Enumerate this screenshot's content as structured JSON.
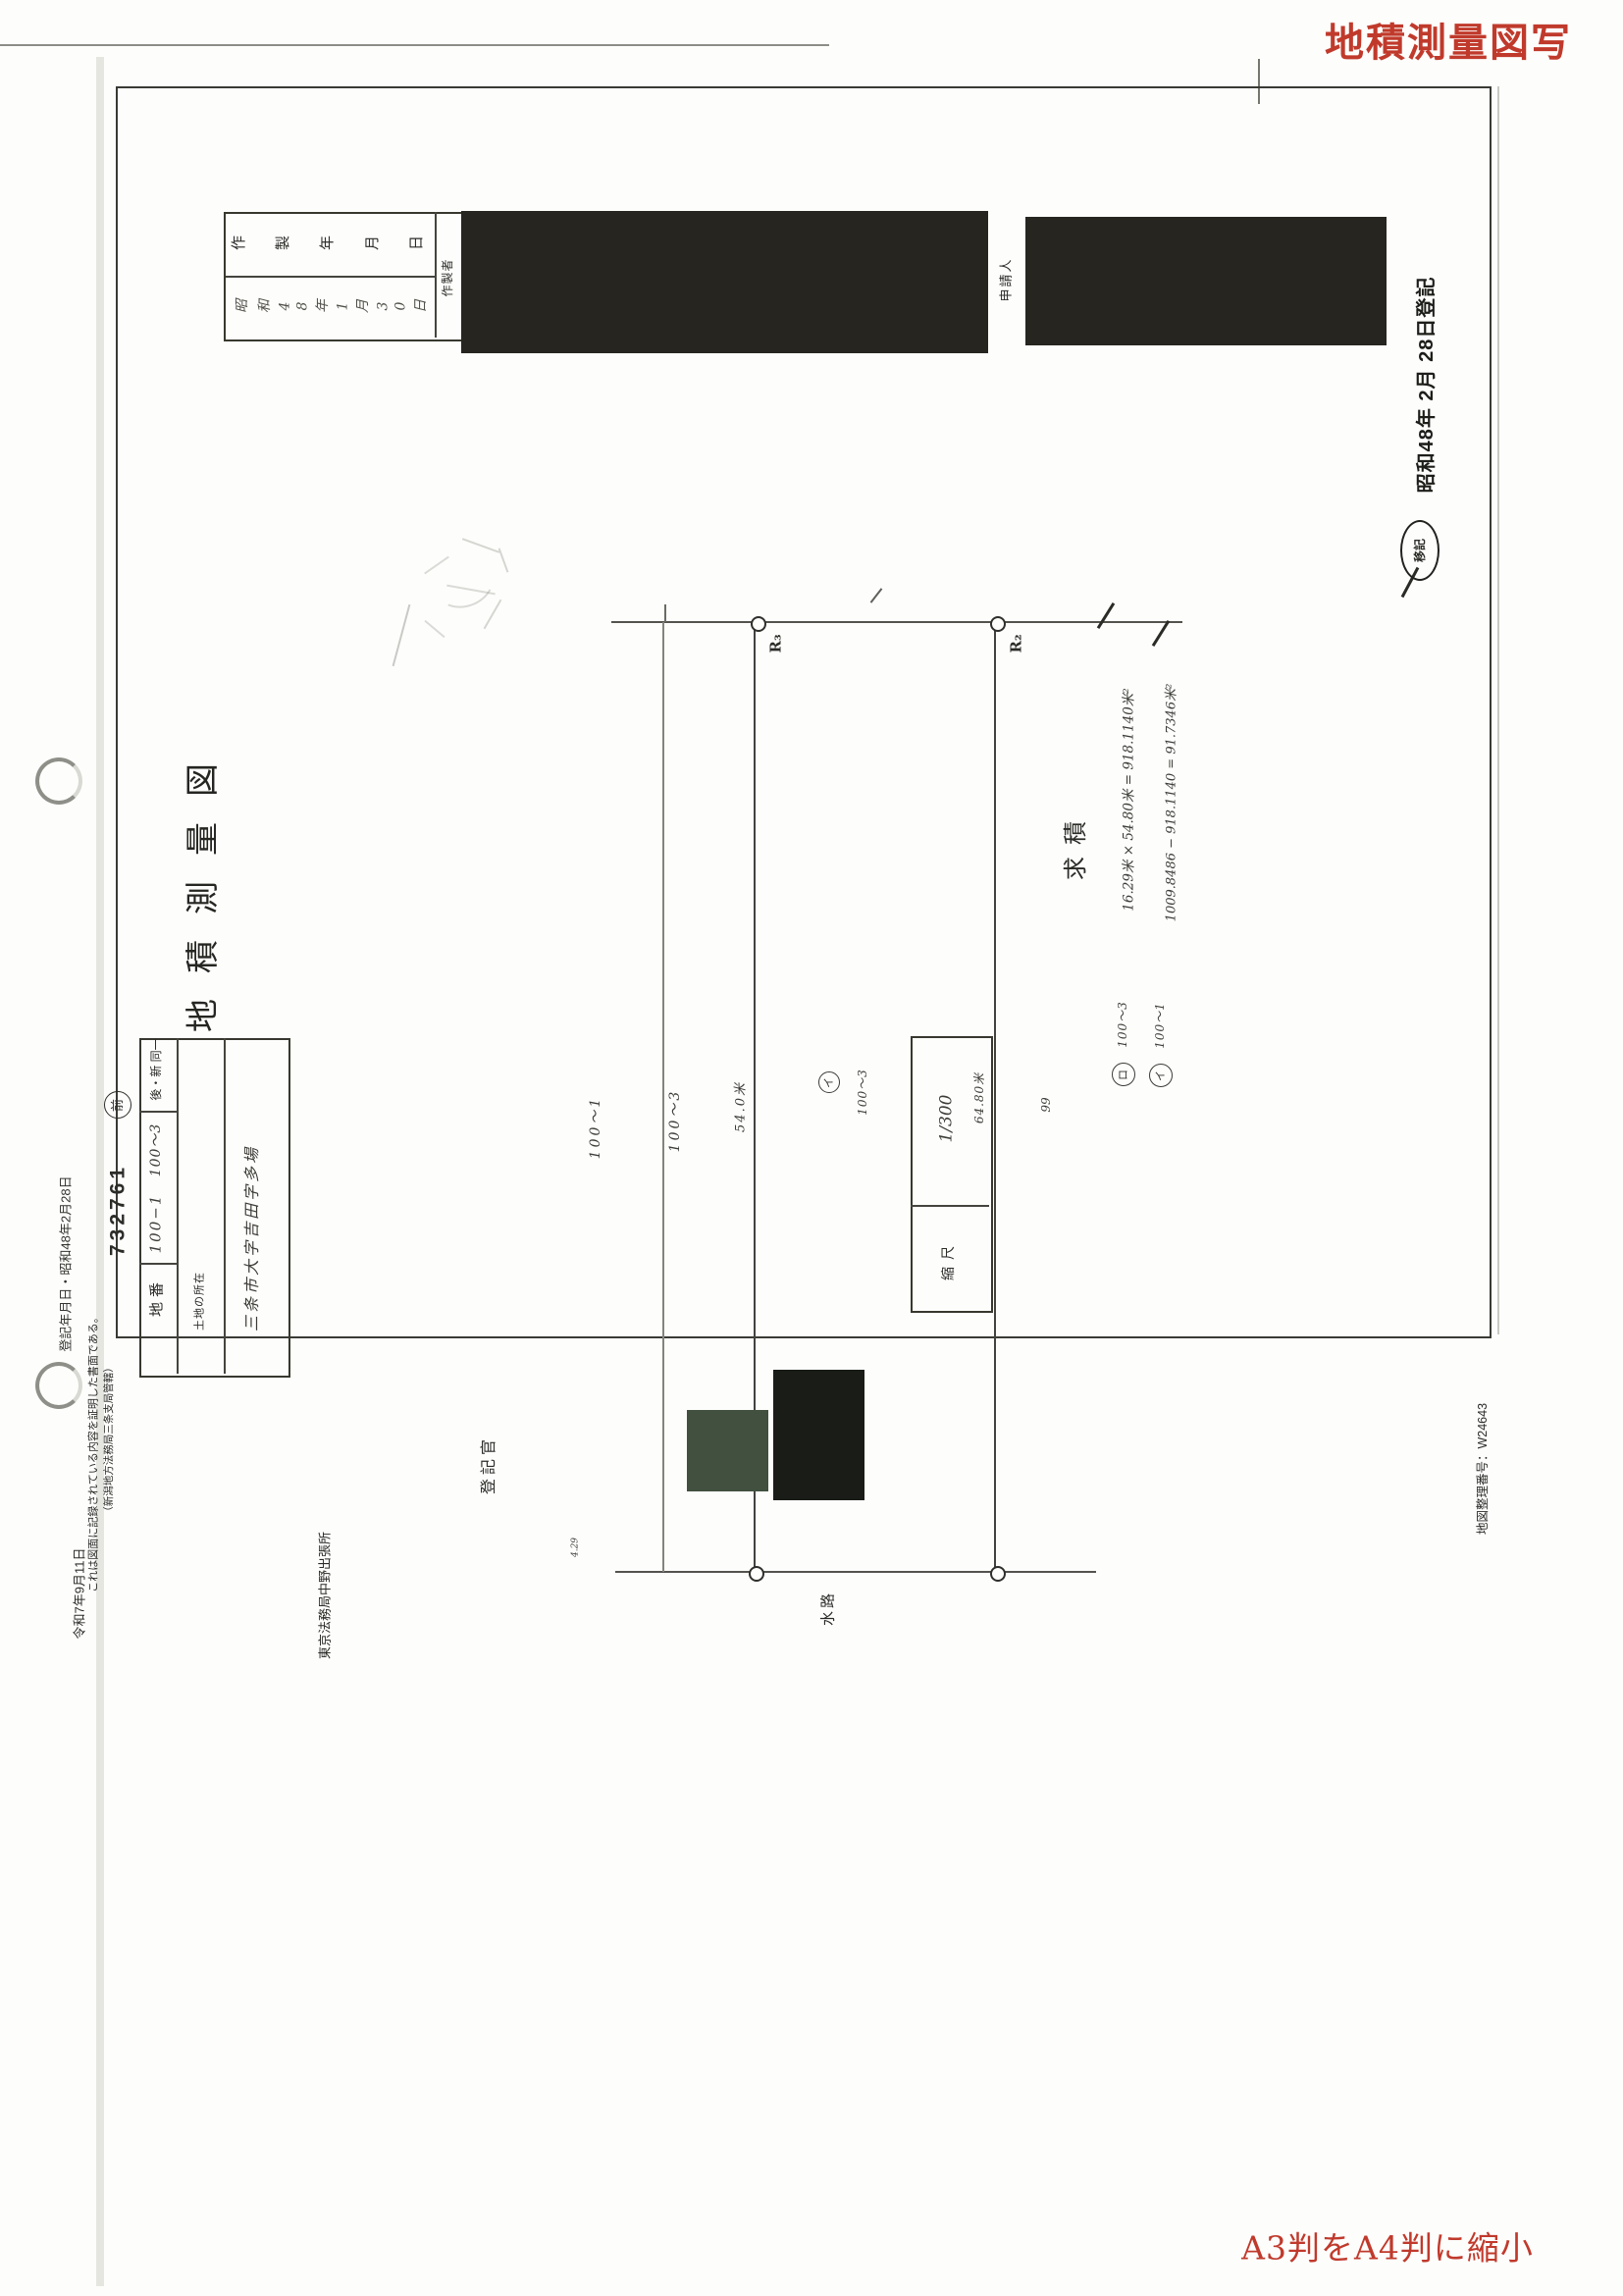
{
  "page": {
    "red_stamp_top": "地積測量図写",
    "red_note_bottom": "A3判をA4判に縮小",
    "map_admin_number": "地図整理番号：W24643",
    "margin_registration_date": "登記年月日・昭和48年2月28日"
  },
  "header_table": {
    "created_date_label": "作製年月日",
    "created_date_value": "昭和48年1月30日",
    "author_label": "作製者",
    "applicant_label": "申請人"
  },
  "title_block": {
    "title": "地積測量図",
    "file_number": "732761",
    "circled_former": "前",
    "parcel_label": "地番",
    "parcel_number_1": "100−1",
    "parcel_number_2": "100〜3",
    "before_after": "後・新 同一",
    "location_label": "土地の所在",
    "location_value": "三条市大字吉田字多場",
    "scale_label": "縮尺",
    "scale_value": "1/300"
  },
  "drawing": {
    "point_r3": "R₃",
    "point_r2": "R₂",
    "waterway_label": "水路",
    "parcel_a": "100〜1",
    "parcel_b": "100〜3",
    "dim_a": "54.0米",
    "circled_i": "イ",
    "parcel_c": "100〜3",
    "dim_b": "64.80米",
    "dim_c": "99",
    "dim_d": "4.29"
  },
  "survey_calc": {
    "heading": "求積",
    "line1": "16.29米 × 54.80米 = 918.1140米²",
    "line2": "1009.8486 − 918.1140 = 91.7346米²",
    "legend1_mark": "ロ",
    "legend1_text": "100〜3",
    "legend2_mark": "イ",
    "legend2_text": "100〜1"
  },
  "right_stamp": {
    "text": "昭和48年 2月 28日登記",
    "circled": "移記"
  },
  "certification": {
    "line1": "これは図面に記録されている内容を証明した書面である。",
    "line2": "（新潟地方法務局三条支局管轄）",
    "date": "令和7年9月11日",
    "office": "東京法務局中野出張所",
    "registrar": "登記官"
  }
}
